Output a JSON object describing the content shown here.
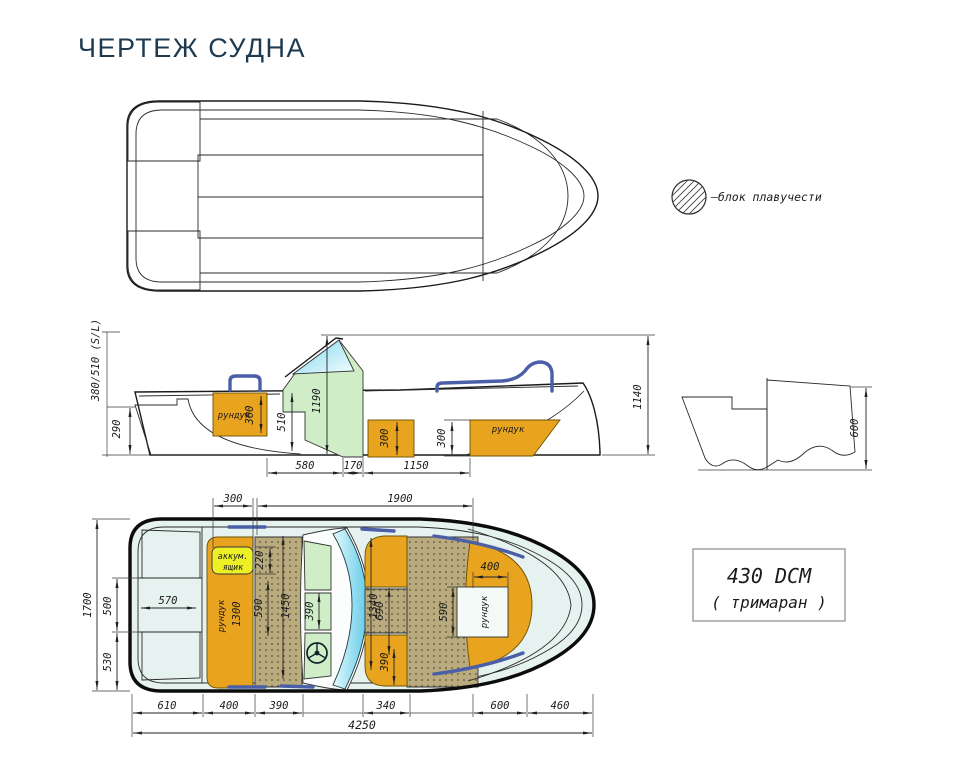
{
  "title": "ЧЕРТЕЖ СУДНА",
  "colors": {
    "title": "#1e3a50",
    "ice": "#e6f2ef",
    "orange": "#e9a41f",
    "yellow": "#eef026",
    "green": "#cfeec8",
    "tan": "#b9ab7d",
    "rail": "#4a5fa8"
  },
  "legend": {
    "label": "–блок плавучести"
  },
  "badge": {
    "model": "430 DCM",
    "type": "( тримаран )"
  },
  "side_view": {
    "shaft_label": "380/510 (S/L)",
    "aft_locker_label": "рундук",
    "bow_locker_label": "рундук",
    "dims": {
      "transom_well": "290",
      "locker_aft_h": "300",
      "cockpit_depth": "510",
      "console_height": "1190",
      "locker_mid_h": "300",
      "locker_bow_h": "300",
      "overall_height": "1140",
      "seg_a": "580",
      "seg_b": "170",
      "seg_c": "1150"
    }
  },
  "transom_view": {
    "dims": {
      "height": "600"
    }
  },
  "plan_view": {
    "battery_line1": "аккум.",
    "battery_line2": "ящик",
    "aft_locker_label": "рундук",
    "aft_locker_length": "1300",
    "bow_locker_label": "рундук",
    "dims": {
      "battery_width": "300",
      "cockpit_length": "1900",
      "beam": "1700",
      "transom_mid": "500",
      "transom_half": "530",
      "motor_well_width": "570",
      "battery_depth": "220",
      "aft_cushion": "590",
      "aft_bench": "1450",
      "console_panel": "390",
      "fwd_seats_span": "1340",
      "fwd_gap": "690",
      "fwd_seat": "390",
      "bow_locker_w": "400",
      "bow_locker_l": "590",
      "seg_stern": "610",
      "seg_aft_locker": "400",
      "seg_aft_cushion": "390",
      "seg_fwd_seats": "340",
      "seg_bow_seat": "600",
      "seg_bow_deck": "460",
      "overall_length": "4250"
    }
  }
}
